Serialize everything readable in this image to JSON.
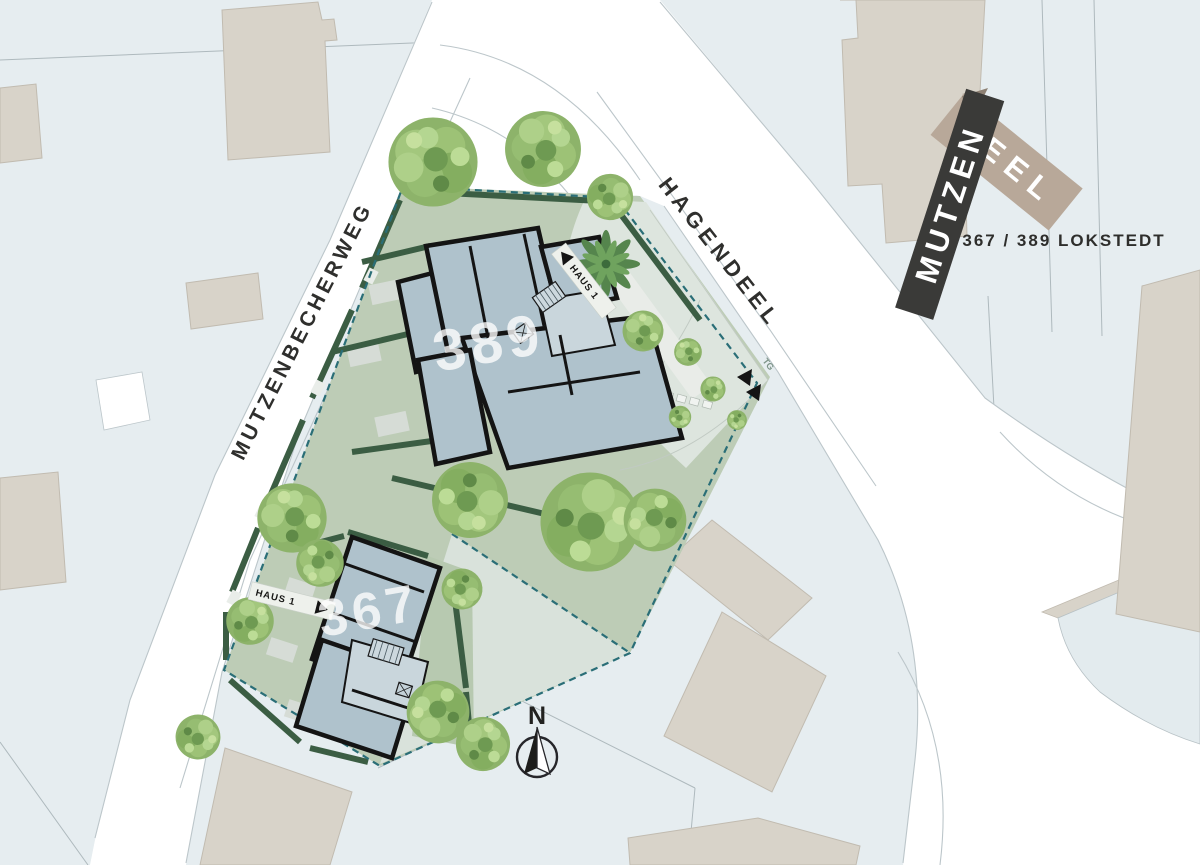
{
  "logo": {
    "word_top": "MUTZEN",
    "word_bottom": "DEEL",
    "subtitle": "367 / 389 LOKSTEDT"
  },
  "streets": {
    "west": "MUTZENBECHERWEG",
    "north": "HAGENDEEL"
  },
  "buildings": [
    {
      "number": "389",
      "entry_label": "HAUS 1"
    },
    {
      "number": "367",
      "entry_label": "HAUS 1"
    }
  ],
  "annotations": {
    "underground_garage": "TG",
    "compass_north": "N"
  },
  "colors": {
    "background": "#e6edf0",
    "street": "#ffffff",
    "site_green": "#bdccb6",
    "site_pale": "#dde5de",
    "hedge": "#3b5d43",
    "boundary_dash": "#2a6e77",
    "building_fill": "#afc2cc",
    "building_wall": "#141414",
    "neighbor_building": "#d8d3c9",
    "tree_green": "#8db36a",
    "logo_dark": "#3a3a38",
    "logo_beige": "#b8a899",
    "label_dark": "#2e2e2c"
  }
}
